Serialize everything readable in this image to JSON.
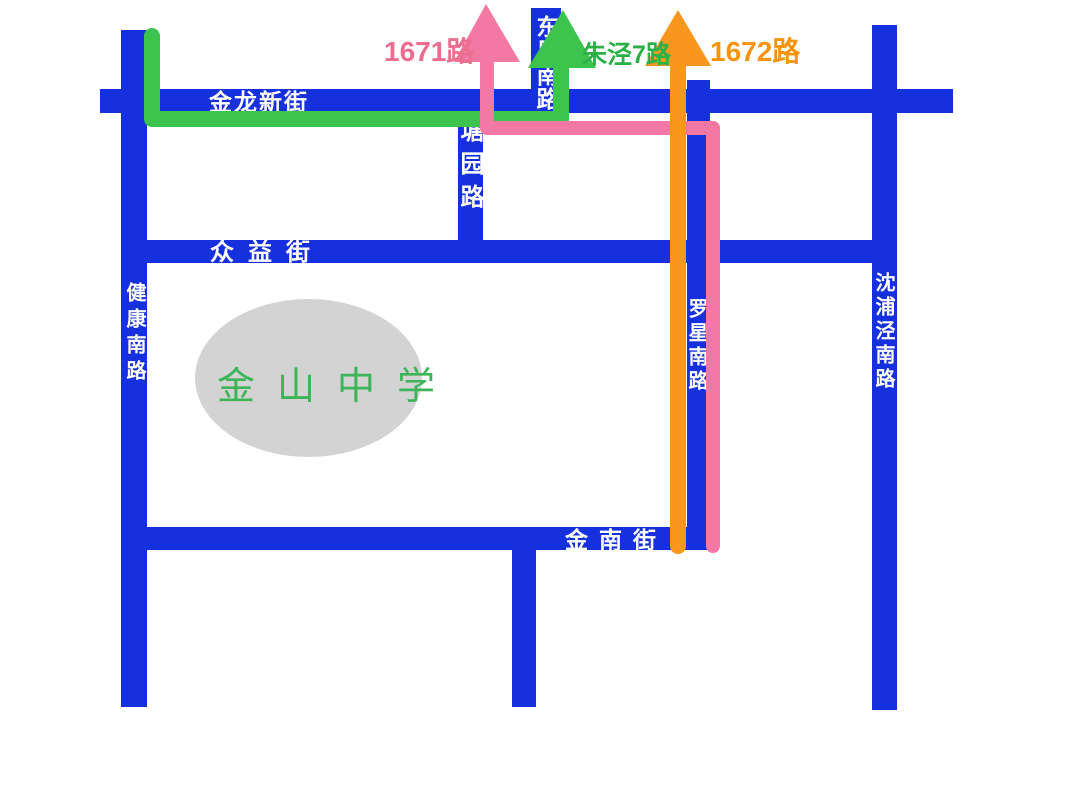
{
  "map": {
    "background_color": "#ffffff",
    "road_color": "#1530dc",
    "road_label_color": "#ffffff"
  },
  "roads": {
    "jinlong_xinjie": "金龙新街",
    "zhongyi_jie": "众益街",
    "jinnan_jie": "金南街",
    "jiankang_nanlu": "健康南路",
    "dongfeng_nanlu": "东风南路",
    "tangyuan_lu": "塘园路",
    "luoxing_nanlu": "罗星南路",
    "shenpujing_nanlu": "沈浦泾南路"
  },
  "bus_routes": {
    "route_1671": {
      "label": "1671路",
      "line_color": "#f478a4",
      "label_color": "#ec6e8e"
    },
    "zhujing_7": {
      "label": "朱泾7路",
      "line_color": "#3dc44f",
      "label_color": "#2baf47"
    },
    "route_1672": {
      "label": "1672路",
      "line_color": "#f8961e",
      "label_color": "#f7930c"
    }
  },
  "school": {
    "name": "金山中学",
    "text_color": "#3cb457",
    "ellipse_color": "#d3d3d3"
  }
}
